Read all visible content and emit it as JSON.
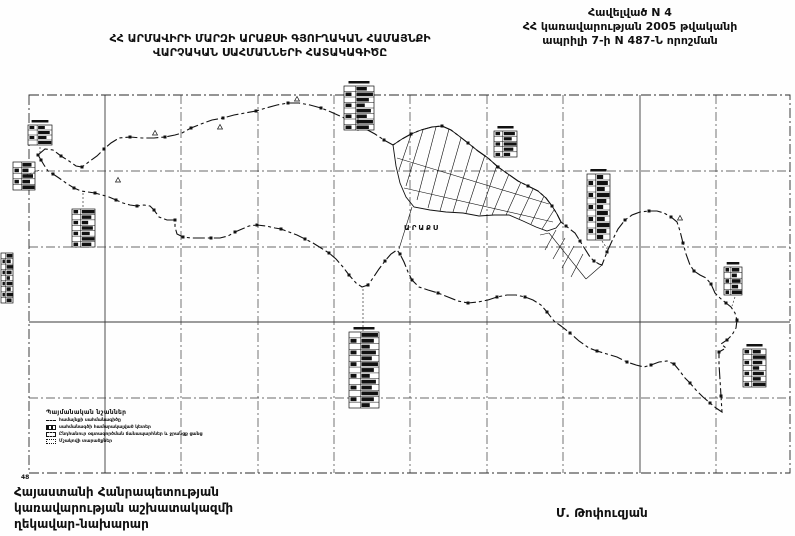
{
  "header": {
    "annex": [
      "Հավելված N 4",
      "ՀՀ կառավարության 2005 թվականի",
      "ապրիլի 7-ի N 487-Ն որոշման"
    ],
    "title": [
      "ՀՀ ԱՐՄԱՎԻՐԻ ՄԱՐԶԻ ԱՐԱՔՍԻ ԳՅՈՒՂԱԿԱՆ ՀԱՄԱՅՆՔԻ",
      "ՎԱՐՉԱԿԱՆ ՍԱՀՄԱՆՆԵՐԻ ՀԱՏԱԿԱԳԻԾԸ"
    ]
  },
  "footer": {
    "left": [
      "Հայաստանի Հանրապետության",
      "կառավարության աշխատակազմի",
      "ղեկավար-նախարար"
    ],
    "signature": "Մ. Թոփուզյան"
  },
  "legend": {
    "header": "Պայմանական նշաններ",
    "items": [
      {
        "symbol": "boundary-line",
        "label": "համայնքի սահմանագիծը"
      },
      {
        "symbol": "boundary-point",
        "label": "սահմանագծի համարակալված կետեր"
      },
      {
        "symbol": "common-lands",
        "label": "Ընդհանուր օգտագործման ճանապարհներ և ջրանցք ցանց"
      },
      {
        "symbol": "cultivated",
        "label": "Մշակովի տարածքներ"
      }
    ]
  },
  "map": {
    "village_label": "ԱՐԱՔՍ",
    "corner_label": "48",
    "colors": {
      "ink": "#111111",
      "grid": "#3a3a3a",
      "frame": "#2a2a2a"
    },
    "frame": {
      "x1": 29,
      "y1": 95,
      "x2": 790,
      "y2": 473
    },
    "grid": {
      "x": [
        105,
        181,
        258,
        334,
        410,
        487,
        563,
        640,
        716
      ],
      "y": [
        171,
        247,
        322,
        398
      ],
      "solid_x": [
        105,
        580,
        640
      ],
      "solid_y": [
        322
      ]
    },
    "boundary": [
      [
        38,
        155
      ],
      [
        45,
        149
      ],
      [
        53,
        150
      ],
      [
        61,
        156
      ],
      [
        69,
        161
      ],
      [
        76,
        166
      ],
      [
        82,
        167
      ],
      [
        90,
        161
      ],
      [
        97,
        156
      ],
      [
        104,
        149
      ],
      [
        111,
        143
      ],
      [
        119,
        138
      ],
      [
        130,
        137
      ],
      [
        142,
        138
      ],
      [
        154,
        138
      ],
      [
        165,
        137
      ],
      [
        175,
        135
      ],
      [
        182,
        133
      ],
      [
        191,
        128
      ],
      [
        201,
        124
      ],
      [
        212,
        120
      ],
      [
        223,
        118
      ],
      [
        234,
        115
      ],
      [
        245,
        113
      ],
      [
        256,
        111
      ],
      [
        266,
        108
      ],
      [
        277,
        105
      ],
      [
        288,
        103
      ],
      [
        299,
        103
      ],
      [
        310,
        105
      ],
      [
        321,
        108
      ],
      [
        331,
        112
      ],
      [
        342,
        117
      ],
      [
        353,
        122
      ],
      [
        364,
        128
      ],
      [
        375,
        134
      ],
      [
        384,
        140
      ],
      [
        393,
        145
      ],
      [
        402,
        139
      ],
      [
        411,
        134
      ],
      [
        421,
        130
      ],
      [
        432,
        127
      ],
      [
        442,
        126
      ],
      [
        451,
        130
      ],
      [
        459,
        136
      ],
      [
        468,
        143
      ],
      [
        478,
        151
      ],
      [
        488,
        158
      ],
      [
        498,
        167
      ],
      [
        508,
        174
      ],
      [
        518,
        181
      ],
      [
        528,
        186
      ],
      [
        538,
        191
      ],
      [
        546,
        198
      ],
      [
        552,
        206
      ],
      [
        557,
        214
      ],
      [
        561,
        222
      ],
      [
        566,
        226
      ],
      [
        571,
        230
      ],
      [
        575,
        233
      ],
      [
        580,
        241
      ],
      [
        585,
        249
      ],
      [
        590,
        257
      ],
      [
        594,
        261
      ],
      [
        599,
        264
      ],
      [
        602,
        265
      ],
      [
        607,
        252
      ],
      [
        612,
        241
      ],
      [
        618,
        229
      ],
      [
        625,
        220
      ],
      [
        632,
        215
      ],
      [
        640,
        212
      ],
      [
        649,
        211
      ],
      [
        657,
        211
      ],
      [
        664,
        213
      ],
      [
        671,
        217
      ],
      [
        677,
        222
      ],
      [
        680,
        231
      ],
      [
        683,
        243
      ],
      [
        686,
        254
      ],
      [
        690,
        265
      ],
      [
        694,
        271
      ],
      [
        700,
        275
      ],
      [
        706,
        278
      ],
      [
        711,
        284
      ],
      [
        715,
        293
      ],
      [
        720,
        298
      ],
      [
        726,
        303
      ],
      [
        731,
        307
      ],
      [
        735,
        313
      ],
      [
        737,
        320
      ],
      [
        736,
        328
      ],
      [
        732,
        335
      ],
      [
        727,
        340
      ],
      [
        721,
        344
      ],
      [
        726,
        348
      ],
      [
        719,
        352
      ],
      [
        719,
        364
      ],
      [
        720,
        380
      ],
      [
        721,
        396
      ],
      [
        722,
        412
      ],
      [
        716,
        408
      ],
      [
        710,
        403
      ],
      [
        703,
        397
      ],
      [
        696,
        390
      ],
      [
        690,
        383
      ],
      [
        685,
        378
      ],
      [
        679,
        370
      ],
      [
        674,
        364
      ],
      [
        667,
        361
      ],
      [
        659,
        362
      ],
      [
        651,
        365
      ],
      [
        644,
        367
      ],
      [
        636,
        365
      ],
      [
        627,
        362
      ],
      [
        617,
        357
      ],
      [
        607,
        354
      ],
      [
        597,
        351
      ],
      [
        589,
        348
      ],
      [
        579,
        341
      ],
      [
        570,
        333
      ],
      [
        561,
        326
      ],
      [
        554,
        321
      ],
      [
        547,
        312
      ],
      [
        541,
        305
      ],
      [
        533,
        300
      ],
      [
        525,
        297
      ],
      [
        516,
        295
      ],
      [
        507,
        295
      ],
      [
        497,
        297
      ],
      [
        488,
        300
      ],
      [
        478,
        302
      ],
      [
        468,
        303
      ],
      [
        458,
        301
      ],
      [
        448,
        297
      ],
      [
        438,
        293
      ],
      [
        428,
        290
      ],
      [
        419,
        287
      ],
      [
        412,
        280
      ],
      [
        408,
        272
      ],
      [
        404,
        262
      ],
      [
        400,
        254
      ],
      [
        397,
        250
      ],
      [
        391,
        254
      ],
      [
        385,
        261
      ],
      [
        379,
        269
      ],
      [
        373,
        278
      ],
      [
        368,
        285
      ],
      [
        362,
        287
      ],
      [
        356,
        283
      ],
      [
        349,
        275
      ],
      [
        343,
        267
      ],
      [
        336,
        259
      ],
      [
        329,
        253
      ],
      [
        321,
        248
      ],
      [
        313,
        243
      ],
      [
        305,
        239
      ],
      [
        297,
        235
      ],
      [
        289,
        232
      ],
      [
        281,
        229
      ],
      [
        275,
        228
      ],
      [
        266,
        226
      ],
      [
        257,
        225
      ],
      [
        249,
        226
      ],
      [
        242,
        229
      ],
      [
        235,
        232
      ],
      [
        228,
        236
      ],
      [
        220,
        238
      ],
      [
        211,
        238
      ],
      [
        201,
        238
      ],
      [
        191,
        238
      ],
      [
        183,
        237
      ],
      [
        177,
        234
      ],
      [
        175,
        227
      ],
      [
        175,
        220
      ],
      [
        167,
        220
      ],
      [
        159,
        217
      ],
      [
        154,
        210
      ],
      [
        150,
        206
      ],
      [
        144,
        205
      ],
      [
        137,
        206
      ],
      [
        130,
        205
      ],
      [
        123,
        203
      ],
      [
        116,
        200
      ],
      [
        109,
        197
      ],
      [
        102,
        195
      ],
      [
        95,
        193
      ],
      [
        88,
        192
      ],
      [
        81,
        191
      ],
      [
        74,
        188
      ],
      [
        66,
        183
      ],
      [
        59,
        178
      ],
      [
        53,
        174
      ],
      [
        48,
        171
      ],
      [
        44,
        165
      ],
      [
        41,
        160
      ]
    ],
    "village_outline": [
      [
        393,
        145
      ],
      [
        402,
        139
      ],
      [
        411,
        134
      ],
      [
        421,
        130
      ],
      [
        432,
        127
      ],
      [
        442,
        126
      ],
      [
        451,
        130
      ],
      [
        459,
        136
      ],
      [
        468,
        143
      ],
      [
        478,
        151
      ],
      [
        488,
        158
      ],
      [
        498,
        167
      ],
      [
        508,
        174
      ],
      [
        518,
        181
      ],
      [
        528,
        186
      ],
      [
        538,
        191
      ],
      [
        546,
        198
      ],
      [
        552,
        206
      ],
      [
        557,
        214
      ],
      [
        561,
        222
      ],
      [
        556,
        228
      ],
      [
        547,
        231
      ],
      [
        536,
        227
      ],
      [
        523,
        221
      ],
      [
        509,
        215
      ],
      [
        494,
        215
      ],
      [
        479,
        216
      ],
      [
        463,
        213
      ],
      [
        446,
        212
      ],
      [
        430,
        210
      ],
      [
        414,
        207
      ],
      [
        406,
        197
      ],
      [
        400,
        183
      ],
      [
        396,
        166
      ]
    ],
    "village_streets": [
      [
        [
          411,
          135
        ],
        [
          399,
          170
        ]
      ],
      [
        [
          423,
          130
        ],
        [
          406,
          186
        ]
      ],
      [
        [
          436,
          127
        ],
        [
          417,
          200
        ]
      ],
      [
        [
          449,
          129
        ],
        [
          428,
          208
        ]
      ],
      [
        [
          461,
          138
        ],
        [
          440,
          211
        ]
      ],
      [
        [
          473,
          146
        ],
        [
          453,
          212
        ]
      ],
      [
        [
          485,
          155
        ],
        [
          466,
          213
        ]
      ],
      [
        [
          497,
          165
        ],
        [
          480,
          215
        ]
      ],
      [
        [
          509,
          174
        ],
        [
          492,
          215
        ]
      ],
      [
        [
          521,
          182
        ],
        [
          506,
          215
        ]
      ],
      [
        [
          533,
          189
        ],
        [
          519,
          219
        ]
      ],
      [
        [
          544,
          196
        ],
        [
          531,
          224
        ]
      ],
      [
        [
          554,
          210
        ],
        [
          542,
          229
        ]
      ],
      [
        [
          397,
          158
        ],
        [
          549,
          204
        ]
      ],
      [
        [
          404,
          188
        ],
        [
          553,
          222
        ]
      ],
      [
        [
          412,
          207
        ],
        [
          399,
          249
        ]
      ]
    ],
    "se_strip": [
      [
        [
          549,
          233
        ],
        [
          586,
          279
        ]
      ],
      [
        [
          556,
          230
        ],
        [
          545,
          250
        ]
      ],
      [
        [
          565,
          238
        ],
        [
          553,
          259
        ]
      ],
      [
        [
          574,
          246
        ],
        [
          562,
          268
        ]
      ],
      [
        [
          583,
          254
        ],
        [
          571,
          277
        ]
      ],
      [
        [
          586,
          279
        ],
        [
          602,
          265
        ]
      ],
      [
        [
          540,
          235
        ],
        [
          549,
          233
        ]
      ]
    ],
    "tables": [
      {
        "x": 28,
        "y": 125,
        "w": 24,
        "h": 20,
        "rows": 4,
        "header": true
      },
      {
        "x": 13,
        "y": 162,
        "w": 22,
        "h": 28,
        "rows": 5,
        "header": false
      },
      {
        "x": 72,
        "y": 209,
        "w": 23,
        "h": 38,
        "rows": 7,
        "header": false
      },
      {
        "x": 344,
        "y": 86,
        "w": 30,
        "h": 44,
        "rows": 8,
        "header": true
      },
      {
        "x": 494,
        "y": 131,
        "w": 23,
        "h": 26,
        "rows": 5,
        "header": true
      },
      {
        "x": 587,
        "y": 174,
        "w": 23,
        "h": 66,
        "rows": 11,
        "header": true
      },
      {
        "x": 724,
        "y": 267,
        "w": 18,
        "h": 28,
        "rows": 5,
        "header": true
      },
      {
        "x": 349,
        "y": 332,
        "w": 30,
        "h": 76,
        "rows": 13,
        "header": true
      },
      {
        "x": 743,
        "y": 349,
        "w": 23,
        "h": 38,
        "rows": 7,
        "header": true
      },
      {
        "x": 1,
        "y": 253,
        "w": 12,
        "h": 50,
        "rows": 9,
        "header": false
      }
    ],
    "leaders": [
      [
        [
          358,
          118
        ],
        [
          358,
          131
        ]
      ],
      [
        [
          363,
          289
        ],
        [
          363,
          332
        ]
      ],
      [
        [
          602,
          241
        ],
        [
          608,
          250
        ]
      ],
      [
        [
          735,
          297
        ],
        [
          732,
          306
        ]
      ],
      [
        [
          83,
          193
        ],
        [
          83,
          209
        ]
      ],
      [
        [
          40,
          147
        ],
        [
          40,
          155
        ]
      ],
      [
        [
          26,
          175
        ],
        [
          40,
          170
        ]
      ]
    ],
    "triangles": [
      [
        220,
        127
      ],
      [
        297,
        99
      ],
      [
        155,
        133
      ],
      [
        680,
        218
      ],
      [
        118,
        180
      ]
    ]
  }
}
